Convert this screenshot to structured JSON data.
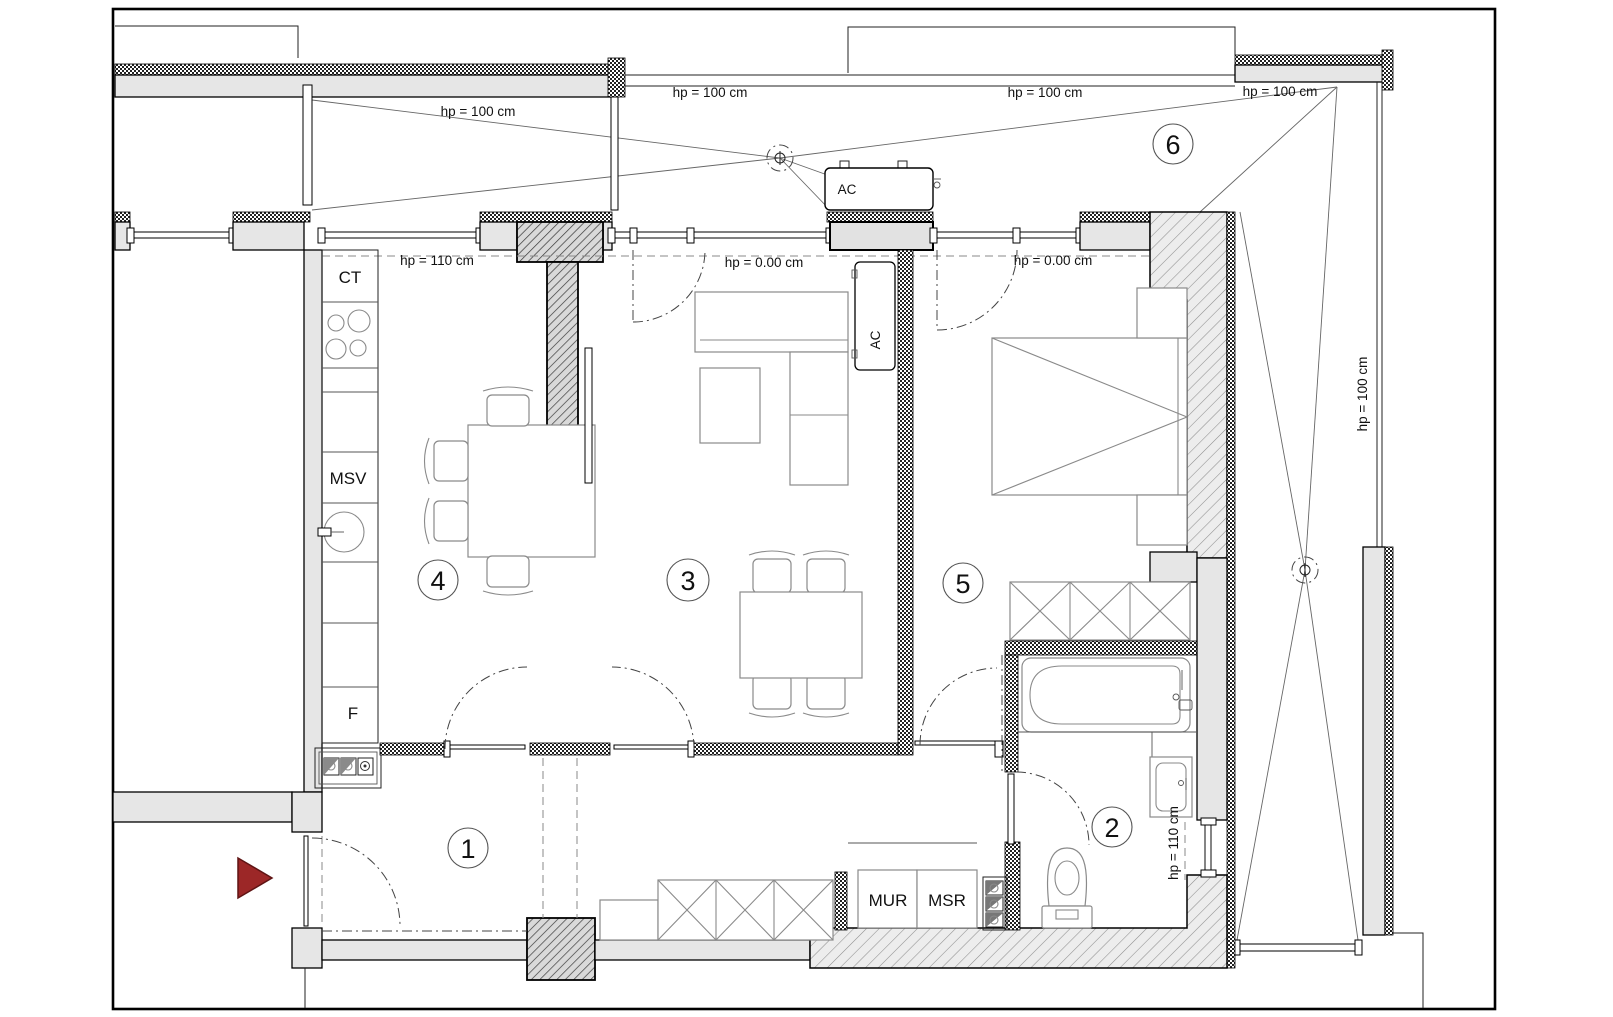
{
  "plan_title": "apartment floor plan",
  "rooms": [
    {
      "number": "1"
    },
    {
      "number": "2"
    },
    {
      "number": "3"
    },
    {
      "number": "4"
    },
    {
      "number": "5"
    },
    {
      "number": "6"
    }
  ],
  "height_labels": {
    "hp100_left": "hp = 100 cm",
    "hp100_mid": "hp = 100 cm",
    "hp100_right": "hp = 100 cm",
    "hp100_corner": "hp = 100 cm",
    "hp100_side": "hp = 100 cm",
    "hp0_living": "hp = 0.00 cm",
    "hp0_bedroom": "hp = 0.00 cm",
    "hp110_kitchen": "hp = 110 cm",
    "hp110_bathroom": "hp = 110 cm"
  },
  "fixtures": {
    "counter": "CT",
    "dishwasher": "MSV",
    "fridge": "F",
    "washer": "MUR",
    "dryer": "MSR",
    "ac_outdoor": "AC",
    "ac_indoor": "AC"
  },
  "colors": {
    "entry_arrow": "#9c2727"
  }
}
